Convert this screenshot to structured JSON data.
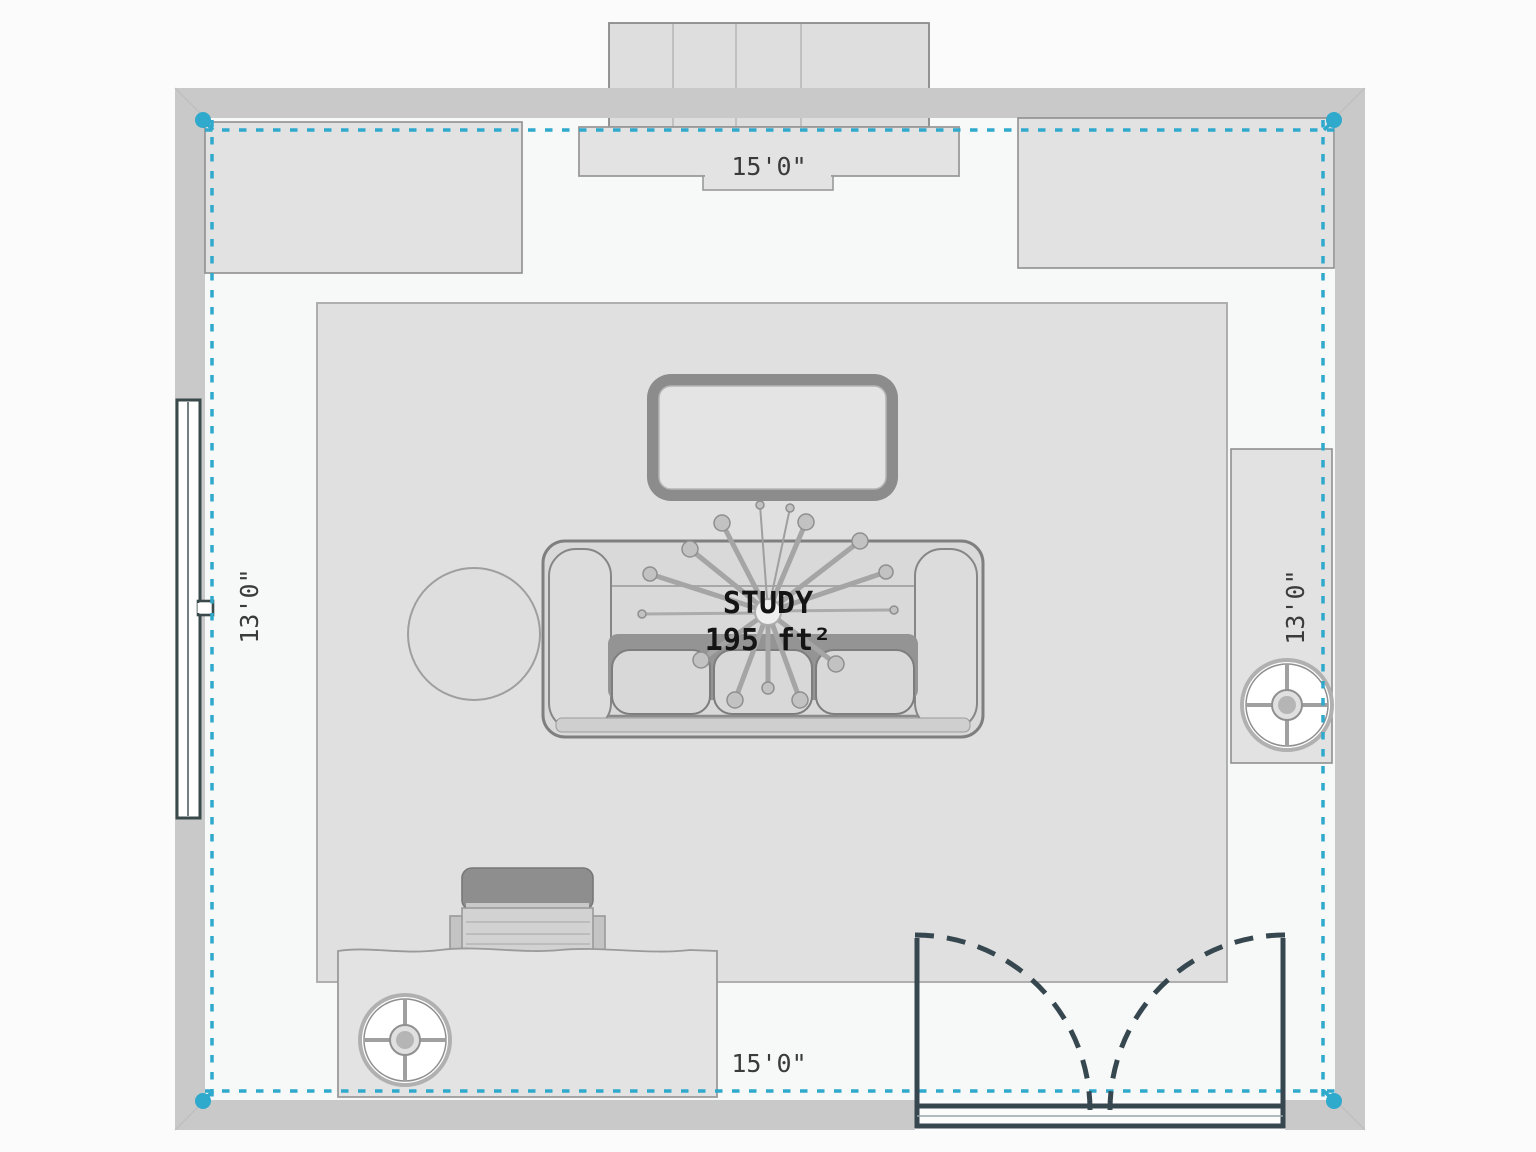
{
  "room": {
    "name": "STUDY",
    "area": "195 ft²"
  },
  "dimensions": {
    "top": "15'0\"",
    "bottom": "15'0\"",
    "left": "13'0\"",
    "right": "13'0\""
  },
  "colors": {
    "accent": "#2FA9CC",
    "wall": "#C9C9C9",
    "floor": "#F7F8F8",
    "outside": "#FBFBFB",
    "furn": "#E2E2E2",
    "rug": "#E0E0E0",
    "outline": "#8F8F8F",
    "door": "#37474F",
    "dim_text": "#3B3B3B",
    "label_text": "#141414"
  },
  "symbols": [
    "wardrobe",
    "console-table",
    "cabinet-top-left",
    "cabinet-top-right",
    "area-rug",
    "coffee-table",
    "sofa",
    "round-side-table",
    "sputnik-ceiling-lamp",
    "window",
    "bookshelf",
    "pedestal-table",
    "desk",
    "office-chair",
    "double-swing-door",
    "room-measure-boundary"
  ]
}
